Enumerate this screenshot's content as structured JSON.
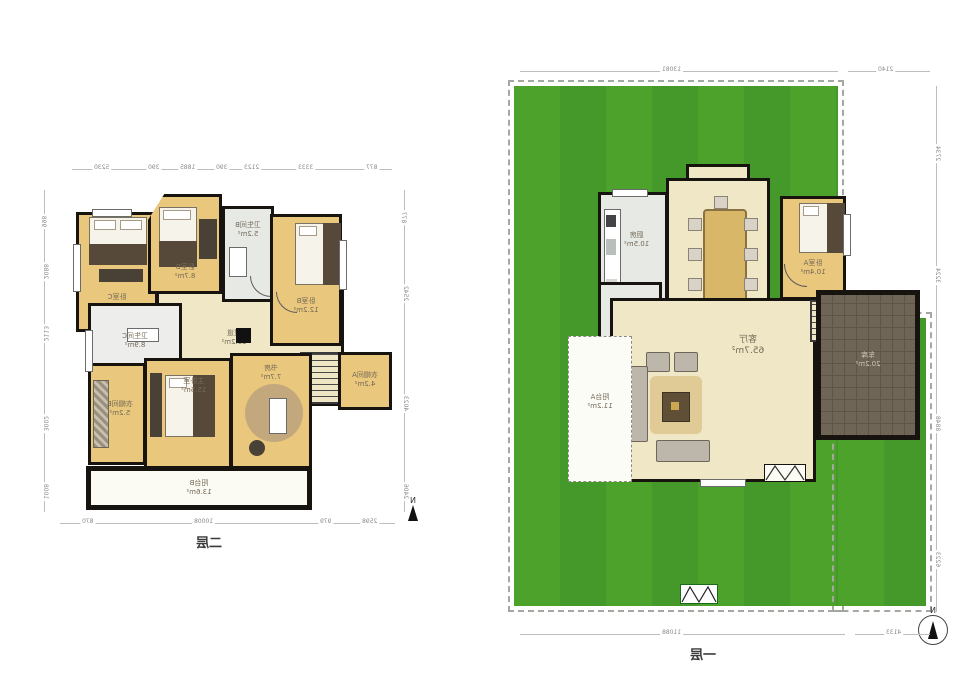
{
  "floor2": {
    "title": "二层",
    "north": "N",
    "rooms": [
      {
        "name": "卧室C",
        "area": "10.9m²"
      },
      {
        "name": "卧室D",
        "area": "8.7m²"
      },
      {
        "name": "卫生间B",
        "area": "5.2m²"
      },
      {
        "name": "卧室B",
        "area": "12.2m²"
      },
      {
        "name": "卫生间C",
        "area": "8.9m²"
      },
      {
        "name": "过道",
        "area": "19.2m²"
      },
      {
        "name": "衣帽间A",
        "area": "4.2m²"
      },
      {
        "name": "衣帽间B",
        "area": "5.2m²"
      },
      {
        "name": "主卧室",
        "area": "15.5m²"
      },
      {
        "name": "书房",
        "area": "7.7m²"
      },
      {
        "name": "阳台B",
        "area": "13.6m²"
      }
    ],
    "dims": {
      "top": [
        "5230",
        "390",
        "1885",
        "390",
        "2123",
        "3333",
        "877"
      ],
      "bottom": [
        "870",
        "10008",
        "979",
        "2598"
      ],
      "left": [
        "998",
        "2088",
        "2113",
        "3002",
        "1008"
      ],
      "right": [
        "877",
        "2542",
        "4023",
        "2406"
      ]
    }
  },
  "floor1": {
    "title": "一层",
    "north": "N",
    "rooms": [
      {
        "name": "厨房",
        "area": "10.5m²"
      },
      {
        "name": "卧室A",
        "area": "10.4m²"
      },
      {
        "name": "卫生间A",
        "area": "5.4m²"
      },
      {
        "name": "客厅",
        "area": "65.7m²"
      },
      {
        "name": "阳台A",
        "area": "11.2m²"
      },
      {
        "name": "车库",
        "area": "20.2m²"
      }
    ],
    "dims": {
      "top": [
        "13081",
        "2140"
      ],
      "bottom": [
        "11088",
        "4133"
      ],
      "right": [
        "2734",
        "3224",
        "8848",
        "6223"
      ]
    }
  },
  "colors": {
    "lawn": "#4da22b",
    "room_yellow": "#e9c77c",
    "corridor": "#f0e7c7",
    "bath_gray": "#e7e9e4",
    "garage": "#6f6557",
    "wall": "#17140f"
  }
}
